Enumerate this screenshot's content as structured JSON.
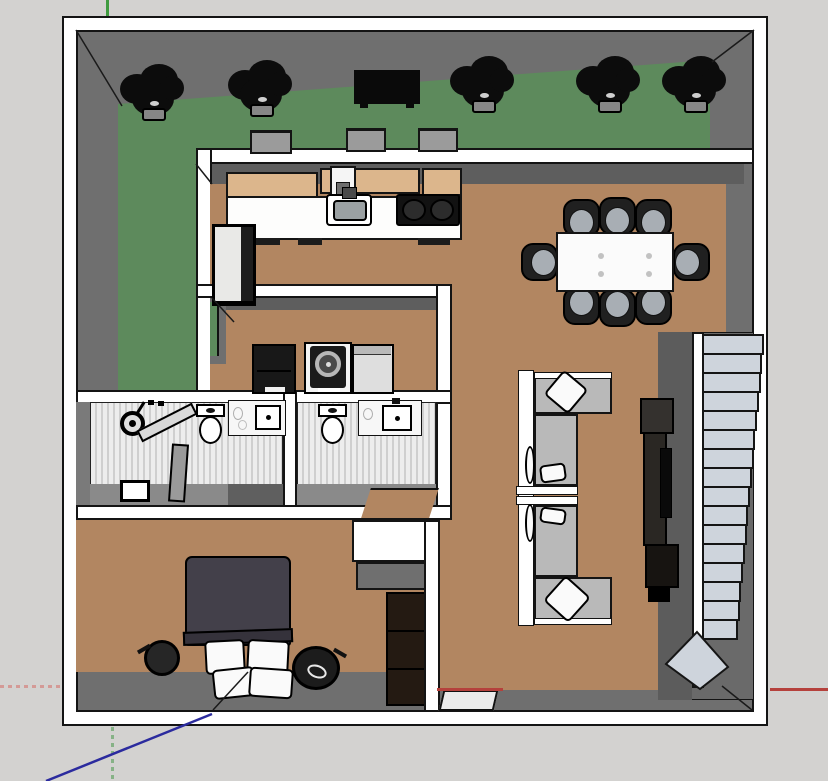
{
  "viewport": {
    "width": 828,
    "height": 781,
    "description": "Top-down 3D floor plan (SketchUp-style viewport) of a house with garden strip, kitchen, dining area, living room, laundry, two bathrooms, bedroom and a staircase; model axes visible (red, green, blue)"
  },
  "palette": {
    "background": "#d3d2d0",
    "wall_white": "#ffffff",
    "outline": "#141414",
    "wall_gray": "#6f6f6f",
    "wall_gray_dark": "#5e5e5e",
    "lawn_green": "#5d8a5c",
    "floor_tan": "#b28661",
    "cabinet_wood": "#dcb68c",
    "tile_light": "#ededed",
    "tile_stripe": "#cfcfcf",
    "stair_tread": "#ced4dc",
    "sofa_gray": "#b9b9b9",
    "furniture_dark": "#1f1f1f",
    "duvet_dark": "#43404a",
    "cabinet_dark_wood": "#241a12",
    "axis_red": "#b5413c",
    "axis_green": "#3f9b3f",
    "axis_blue": "#2b2b9e",
    "axis_red_faded": "#d49a96",
    "axis_green_faded": "#86b286"
  },
  "scene": {
    "garden": {
      "plant_count": 5,
      "plants": [
        {
          "x": 120,
          "y": 64
        },
        {
          "x": 228,
          "y": 60
        },
        {
          "x": 450,
          "y": 56
        },
        {
          "x": 576,
          "y": 56
        },
        {
          "x": 662,
          "y": 56
        }
      ],
      "bench": {
        "x": 354,
        "y": 70,
        "w": 66,
        "h": 34
      },
      "window_boxes": [
        {
          "x": 250,
          "y": 130,
          "w": 42,
          "h": 24
        },
        {
          "x": 346,
          "y": 128,
          "w": 40,
          "h": 24
        },
        {
          "x": 418,
          "y": 128,
          "w": 40,
          "h": 24
        }
      ]
    },
    "kitchen": {
      "items": [
        "upper cabinets",
        "range hood",
        "countertop",
        "sink",
        "cooktop",
        "refrigerator"
      ]
    },
    "dining": {
      "chair_count": 8,
      "chairs": [
        {
          "cx": 581,
          "cy": 218,
          "side": "top"
        },
        {
          "cx": 617,
          "cy": 216,
          "side": "top"
        },
        {
          "cx": 653,
          "cy": 218,
          "side": "top"
        },
        {
          "cx": 581,
          "cy": 306,
          "side": "bottom"
        },
        {
          "cx": 617,
          "cy": 308,
          "side": "bottom"
        },
        {
          "cx": 653,
          "cy": 306,
          "side": "bottom"
        },
        {
          "cx": 539,
          "cy": 262,
          "side": "left"
        },
        {
          "cx": 691,
          "cy": 262,
          "side": "right"
        }
      ]
    },
    "laundry": {
      "appliances": [
        "laundry cabinet",
        "front-load washer",
        "dryer"
      ]
    },
    "bathroom_1": {
      "fixtures": [
        "shower",
        "glass screen",
        "door",
        "toilet",
        "vanity sink",
        "floor box"
      ]
    },
    "bathroom_2": {
      "fixtures": [
        "toilet",
        "vanity sink",
        "open doorway"
      ]
    },
    "bedroom": {
      "furniture": [
        "double bed",
        "4 pillows",
        "nightstand left",
        "nightstand right",
        "tall wardrobe",
        "closet"
      ],
      "pillow_count": 4
    },
    "living_room": {
      "furniture": [
        "sectional sofa",
        "two coffee tables",
        "tv console",
        "tv"
      ]
    },
    "stairs": {
      "step_count": 16,
      "x": 702,
      "top": 334,
      "step_height": 19,
      "width_start": 62,
      "width_end": 36
    }
  }
}
